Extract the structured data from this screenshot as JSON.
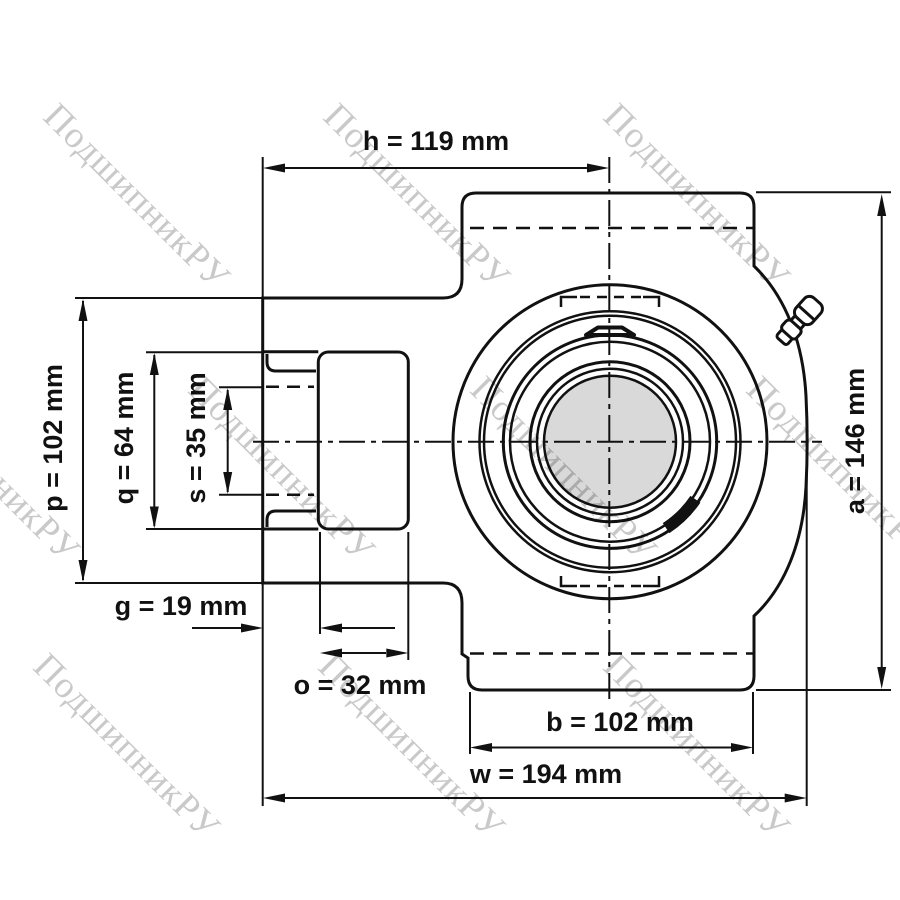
{
  "drawing_title": "",
  "watermark": {
    "text": "ПодшипникРУ",
    "color": "#c9c9c9"
  },
  "colors": {
    "line": "#111111",
    "bore_fill": "#d9d9d9",
    "background": "#ffffff"
  },
  "dimensions": {
    "h": {
      "name": "h",
      "value": 119,
      "unit": "mm",
      "label": "h = 119 mm"
    },
    "p": {
      "name": "p",
      "value": 102,
      "unit": "mm",
      "label": "p = 102 mm"
    },
    "q": {
      "name": "q",
      "value": 64,
      "unit": "mm",
      "label": "q = 64 mm"
    },
    "s": {
      "name": "s",
      "value": 35,
      "unit": "mm",
      "label": "s = 35 mm"
    },
    "g": {
      "name": "g",
      "value": 19,
      "unit": "mm",
      "label": "g = 19 mm"
    },
    "o": {
      "name": "o",
      "value": 32,
      "unit": "mm",
      "label": "o = 32 mm"
    },
    "b": {
      "name": "b",
      "value": 102,
      "unit": "mm",
      "label": "b = 102 mm"
    },
    "w": {
      "name": "w",
      "value": 194,
      "unit": "mm",
      "label": "w = 194 mm"
    },
    "a": {
      "name": "a",
      "value": 146,
      "unit": "mm",
      "label": "a = 146 mm"
    }
  }
}
